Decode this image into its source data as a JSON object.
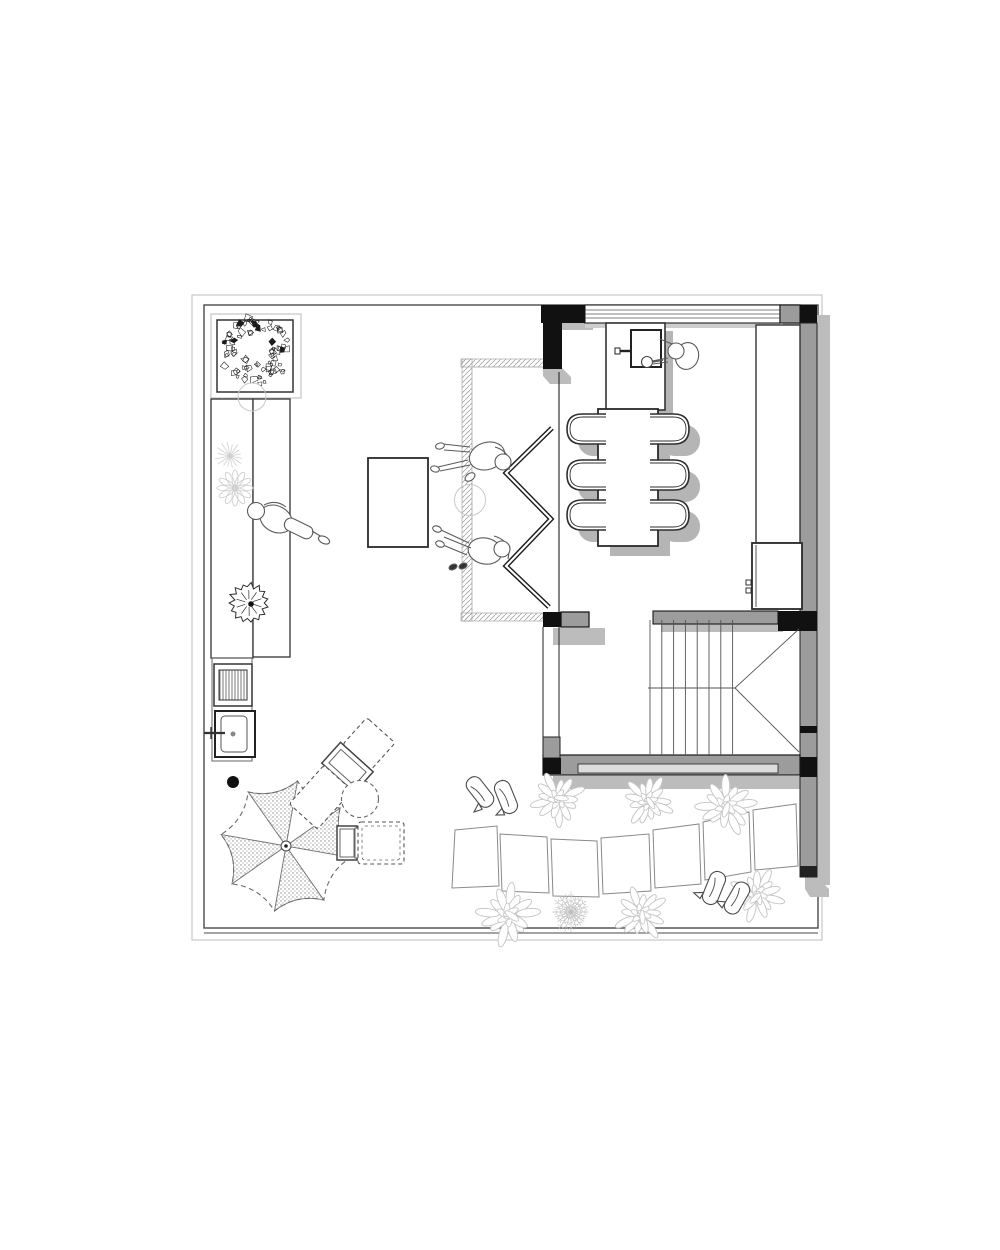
{
  "document": {
    "type": "architectural-floor-plan",
    "view": "top-down roof-terrace / dining level plan",
    "style": "black and white line drawing, gray poché walls, drop shadows, no text labels"
  },
  "palette": {
    "background": "#ffffff",
    "wall_gray": "#9c9c9c",
    "wall_black": "#111111",
    "shadow": "#bcbcbc",
    "shadow_light": "#cdcdcd",
    "line_dark": "#2f2f2f",
    "line_mid": "#5a5a5a",
    "line_light": "#c6c6c6",
    "hatch": "#a3a3a3"
  },
  "elements": {
    "areas": [
      "roof-terrace",
      "dining-room",
      "stair-hall",
      "garden-strip"
    ],
    "symbols": [
      "tree-in-planter",
      "garden-bench",
      "person-lounging-bench",
      "coffee-table",
      "person-seated-top",
      "person-seated-bottom",
      "accordion-glass-door",
      "door-recess-hatch",
      "dining-table",
      "dining-chair-x6",
      "kitchen-island",
      "cooktop",
      "person-cooking",
      "tall-counter",
      "low-cabinet",
      "staircase",
      "parasol",
      "lounge-chair-x2",
      "side-table",
      "outdoor-sink",
      "grill-cabinet",
      "floor-drain",
      "stepping-stones-x7",
      "shrub-x6",
      "fern-plant",
      "slippers-x2",
      "starburst-plant",
      "flower-plant",
      "palm-plant"
    ]
  },
  "decor": {
    "tree": {
      "cx": 255,
      "cy": 351,
      "r": 35,
      "leaves": 80
    },
    "ghost_circles": [
      {
        "cx": 252,
        "cy": 397,
        "r": 14
      },
      {
        "cx": 470,
        "cy": 500,
        "r": 15.5
      }
    ],
    "starburst": {
      "cx": 230,
      "cy": 456,
      "r": 15,
      "rays": 16
    },
    "flower": {
      "cx": 235,
      "cy": 488,
      "petals": 12
    },
    "palm": {
      "cx": 249,
      "cy": 603,
      "r": 20
    },
    "fern": {
      "cx": 571,
      "cy": 912,
      "r": 21,
      "rays": 20
    },
    "shrubs": [
      {
        "x": 558,
        "y": 799,
        "s": 1.0,
        "rot": 0.3
      },
      {
        "x": 648,
        "y": 801,
        "s": 0.95,
        "rot": 1.2
      },
      {
        "x": 726,
        "y": 806,
        "s": 1.1,
        "rot": 2.1
      },
      {
        "x": 508,
        "y": 915,
        "s": 1.15,
        "rot": 0.8
      },
      {
        "x": 641,
        "y": 914,
        "s": 1.0,
        "rot": 1.7
      },
      {
        "x": 757,
        "y": 895,
        "s": 1.0,
        "rot": 2.6
      }
    ]
  }
}
